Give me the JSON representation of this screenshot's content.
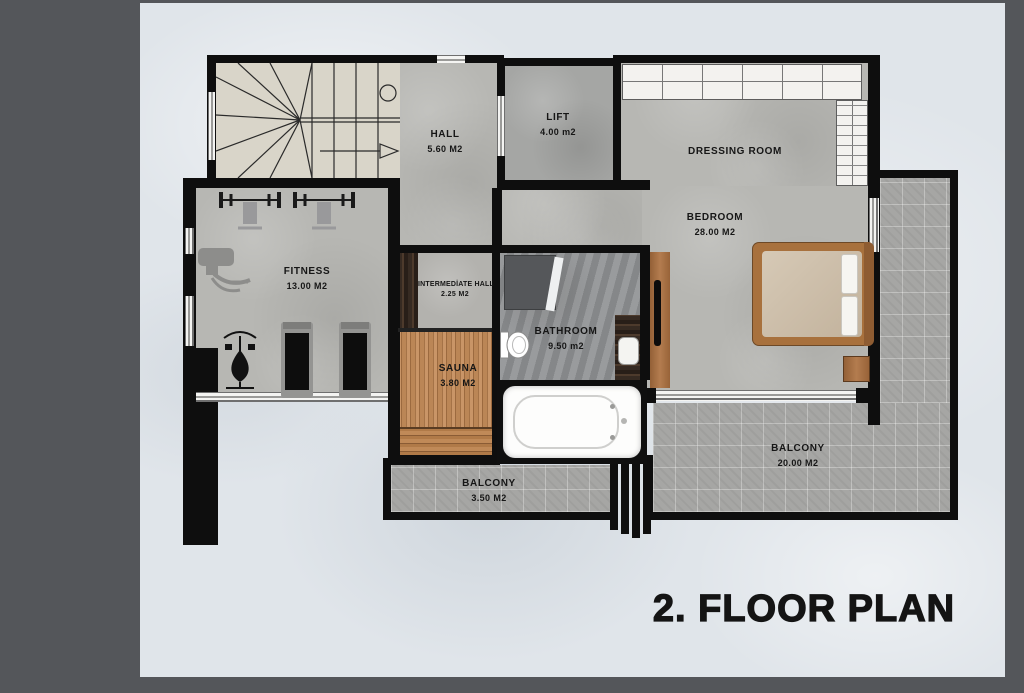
{
  "title": "2. FLOOR PLAN",
  "rooms": {
    "hall": {
      "label": "HALL",
      "area": "5.60 M2"
    },
    "lift": {
      "label": "LIFT",
      "area": "4.00 m2"
    },
    "dressing_room": {
      "label": "DRESSING ROOM",
      "area": ""
    },
    "bedroom": {
      "label": "BEDROOM",
      "area": "28.00 M2"
    },
    "fitness": {
      "label": "FITNESS",
      "area": "13.00 M2"
    },
    "intermediate_hall": {
      "label": "INTERMEDİATE HALL",
      "area": "2.25 M2"
    },
    "bathroom": {
      "label": "BATHROOM",
      "area": "9.50 m2"
    },
    "sauna": {
      "label": "SAUNA",
      "area": "3.80 M2"
    },
    "balcony_small": {
      "label": "BALCONY",
      "area": "3.50 M2"
    },
    "balcony_large": {
      "label": "BALCONY",
      "area": "20.00 M2"
    }
  },
  "colors": {
    "frame_background": "#54565a",
    "paper": "#e0e5ea",
    "wall": "#0e0e0e",
    "concrete_floor": "#b7b7b3",
    "stone_floor": "#8f9193",
    "stair_floor": "#d9d5c9",
    "sauna_wood": "#bb8656",
    "dark_walnut": "#332620",
    "furniture_wood": "#ad7140",
    "balcony_tile": "#a6a6a4",
    "label_text": "#161616"
  }
}
